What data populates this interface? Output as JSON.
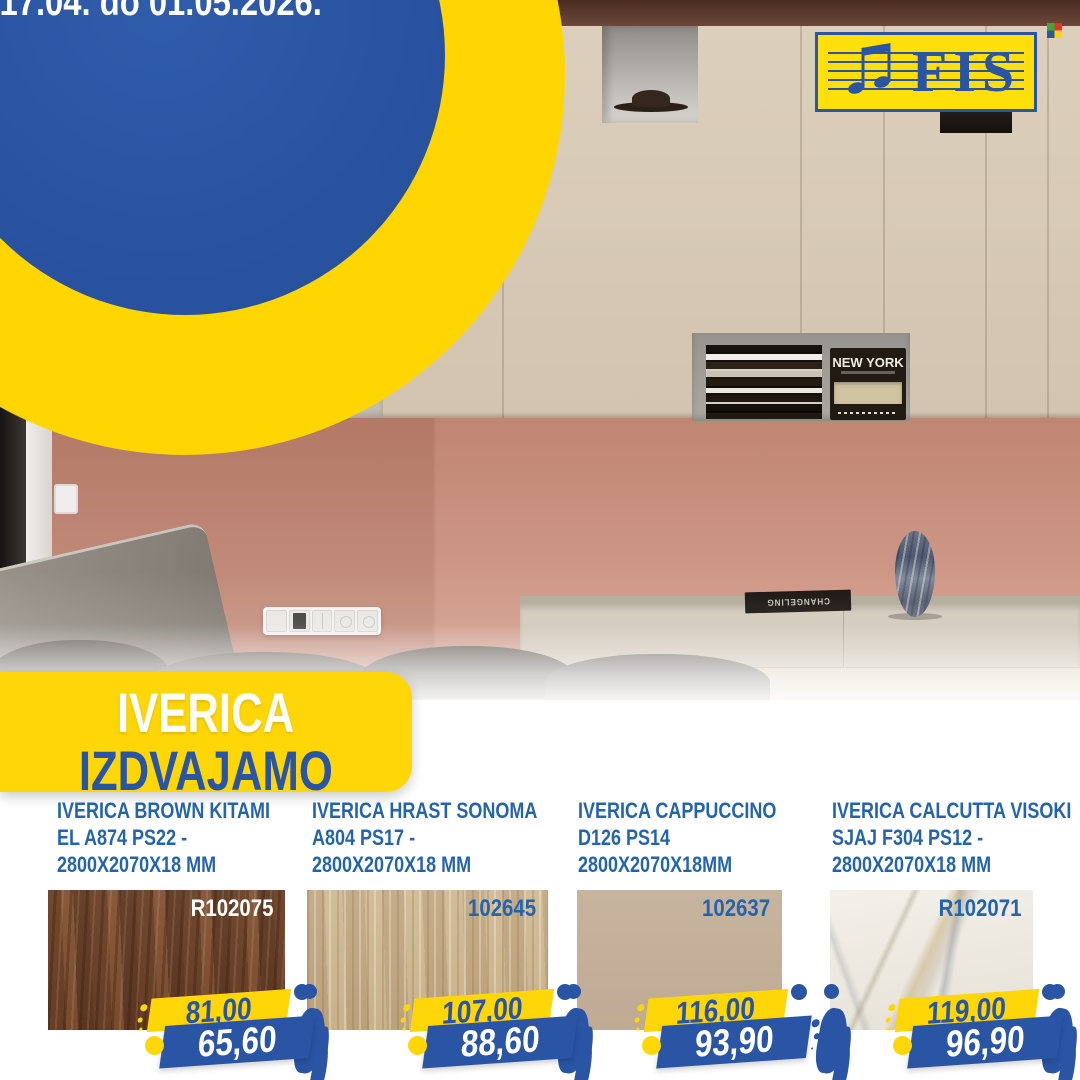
{
  "hero": {
    "badge_title": "AKCIJA",
    "badge_dates": "od 17.04. do 01.05.2026.",
    "logo_text": "FIS"
  },
  "section_banner": {
    "line1": "IVERICA",
    "line2": "IZDVAJAMO"
  },
  "photo": {
    "book_spine_title": "NEW YORK",
    "flat_book_title": "CHANGELING"
  },
  "products": [
    {
      "name_lines": [
        "IVERICA BROWN KITAMI",
        "EL A874 PS22 -",
        "2800X2070X18 MM"
      ],
      "code": "R102075",
      "old_price": "81,00",
      "new_price": "65,60",
      "swatch": "brown-kitami-wood"
    },
    {
      "name_lines": [
        "IVERICA HRAST SONOMA",
        "A804 PS17 -",
        "2800X2070X18 MM"
      ],
      "code": "102645",
      "old_price": "107,00",
      "new_price": "88,60",
      "swatch": "sonoma-oak-wood"
    },
    {
      "name_lines": [
        "IVERICA CAPPUCCINO",
        "D126 PS14",
        "2800X2070X18MM"
      ],
      "code": "102637",
      "old_price": "116,00",
      "new_price": "93,90",
      "swatch": "cappuccino-plain"
    },
    {
      "name_lines": [
        "IVERICA CALCUTTA VISOKI",
        "SJAJ F304 PS12 -",
        "2800X2070X18 MM"
      ],
      "code": "R102071",
      "old_price": "119,00",
      "new_price": "96,90",
      "swatch": "calcutta-marble"
    }
  ],
  "colors": {
    "brand_blue": "#2a55a4",
    "brand_yellow": "#ffd608",
    "title_blue": "#2464ad",
    "new_price_text": "#ffffff",
    "ceiling_brown": "#5d3a2f",
    "cabinet_cream": "#d7cab6",
    "wall_salmon": "#c98d7a"
  }
}
